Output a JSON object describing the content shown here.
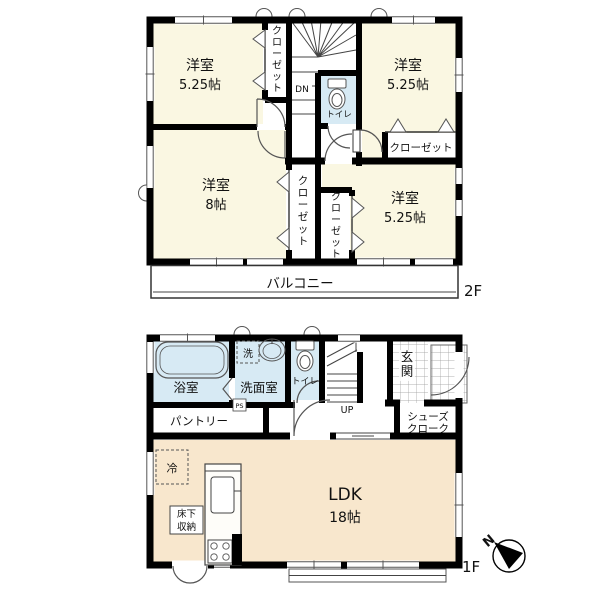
{
  "floorplan": {
    "f2": {
      "floor_label": "2F",
      "r1_name": "洋室",
      "r1_size": "5.25帖",
      "r2_name": "洋室",
      "r2_size": "5.25帖",
      "r3_name": "洋室",
      "r3_size": "8帖",
      "r4_name": "洋室",
      "r4_size": "5.25帖",
      "closet1": "クローゼット",
      "closet2": "クローゼット",
      "closet3": "クローゼット",
      "closet4": "クローゼット",
      "toilet": "トイレ",
      "stairs_down": "DN",
      "balcony": "バルコニー"
    },
    "f1": {
      "floor_label": "1F",
      "bathroom": "浴室",
      "washroom": "洗面室",
      "washer": "洗",
      "toilet": "トイレ",
      "stairs_up": "UP",
      "entrance": "玄関",
      "shoes_line1": "シューズ",
      "shoes_line2": "クローク",
      "pantry": "パントリー",
      "pipe_space": "PS",
      "ldk_name": "LDK",
      "ldk_size": "18帖",
      "storage_line1": "床下",
      "storage_line2": "収納",
      "fridge": "冷"
    },
    "compass_north": "N",
    "colors": {
      "wall": "#000000",
      "room_cream": "#FAF7E2",
      "room_peach": "#F8E7CD",
      "wet_blue": "#D7EAF4",
      "grid_line": "#999999"
    }
  }
}
